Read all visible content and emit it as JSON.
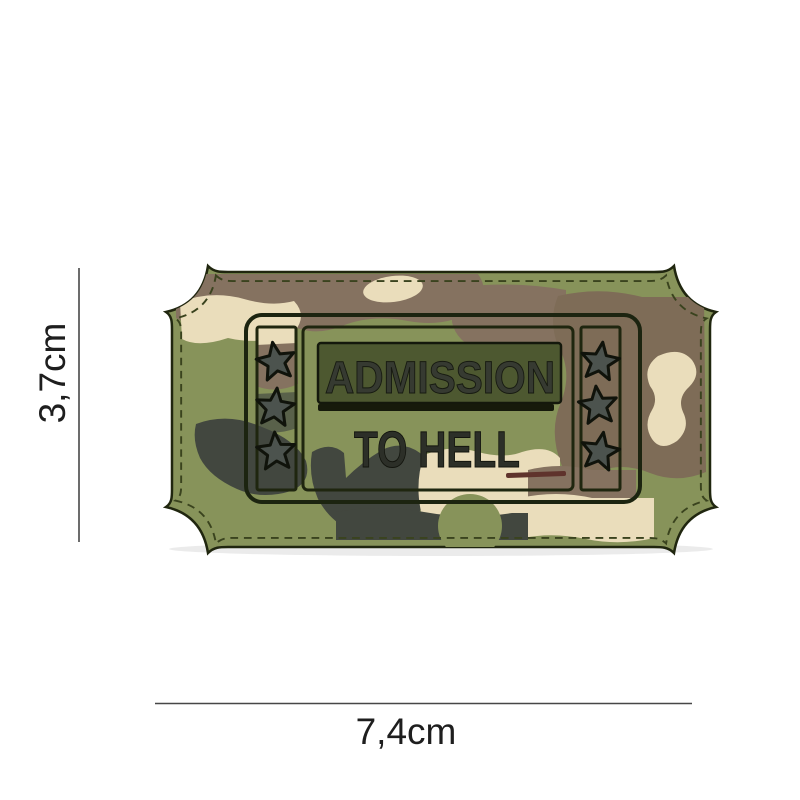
{
  "image_type": "product photo of a PVC morale patch with dimension annotations",
  "patch": {
    "line1": "ADMISSION",
    "line2": "TO HELL",
    "shape": "ticket with concave notched corners and stitched border",
    "left_star_count": 3,
    "right_star_count": 3,
    "colors": {
      "olive_base": "#87935A",
      "camo_brown": "#857260",
      "camo_cream": "#EADDBB",
      "camo_dark_gray": "#42473F",
      "outline_dark": "#20260F",
      "stitch": "#3A431E",
      "title_panel": "#4D5830",
      "letters": "#31362C",
      "star_fill": "#4C534E"
    }
  },
  "dimensions": {
    "height_label": "3,7cm",
    "width_label": "7,4cm",
    "line_color": "#474747"
  }
}
